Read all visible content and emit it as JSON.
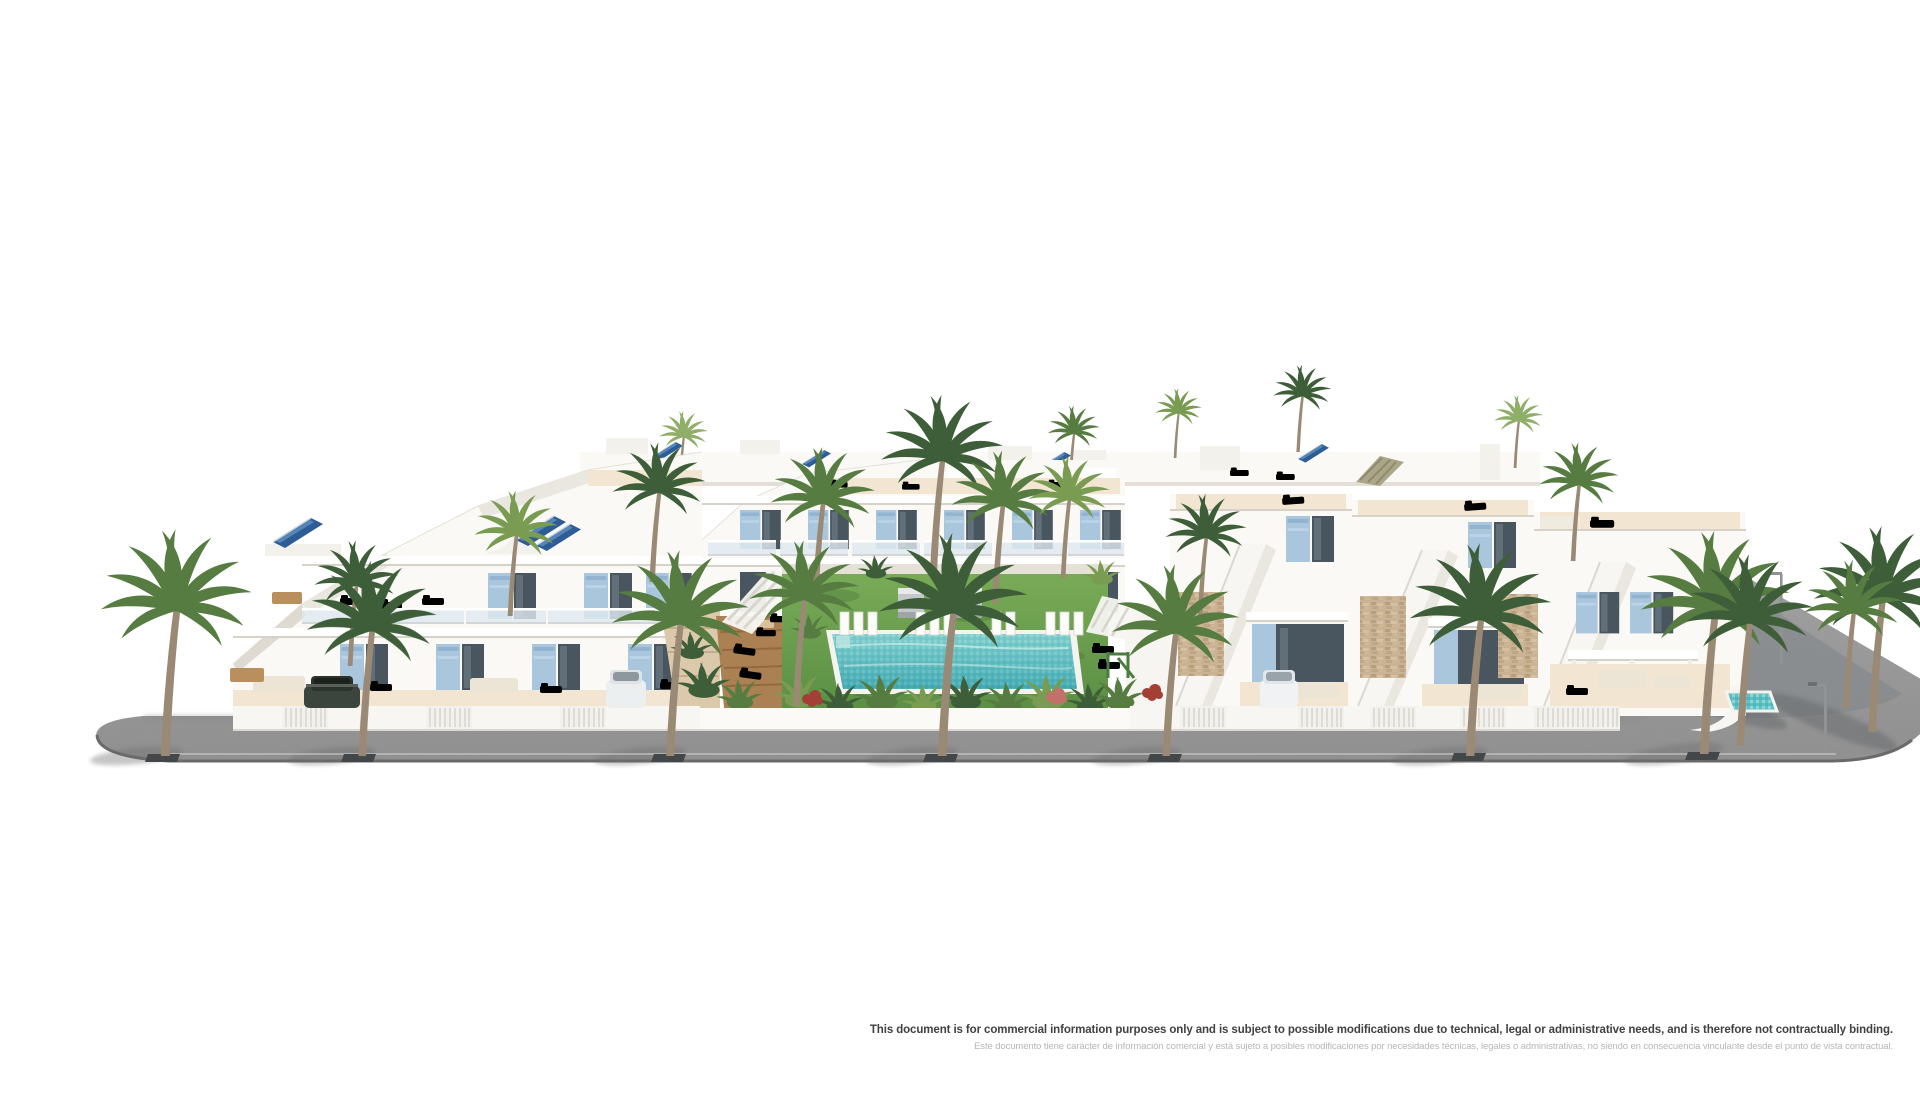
{
  "page": {
    "background": "#ffffff"
  },
  "scene": {
    "description": "3D architectural rendering of a white Mediterranean residential complex: terraced apartments with blue shutters and rooftop solar panels, a communal garden with swimming pool, sun loungers and pergolas, detached villas with external staircases and stone-clad walls, palm trees and a grey street with drain grates and street lamps in front",
    "colors": {
      "wall": "#faf9f6",
      "wall_shade": "#eae7e0",
      "shutter_blue": "#a9c6dd",
      "window_glass": "#4a565f",
      "solar_panel": "#2e5d95",
      "lawn": "#6da34f",
      "pool_water": "#5fc0c4",
      "road": "#9b9b9b",
      "terrace_sand": "#f2e6d3",
      "deck_wood": "#ab8153",
      "stone_cladding": "#c9b394",
      "palm_dark": "#3d5e38",
      "palm_mid": "#567c41",
      "palm_light": "#7a9c52",
      "flower_red": "#a33f36"
    }
  },
  "disclaimer": {
    "line1_en": "This document is for commercial information purposes only and is subject to possible modifications due to technical, legal or administrative needs, and is therefore not contractually binding.",
    "line2_es": "Este documento tiene carácter de información comercial y está sujeto a posibles modificaciones por necesidades técnicas, legales o administrativas, no siendo en consecuencia vinculante desde el punto de vista contractual."
  }
}
